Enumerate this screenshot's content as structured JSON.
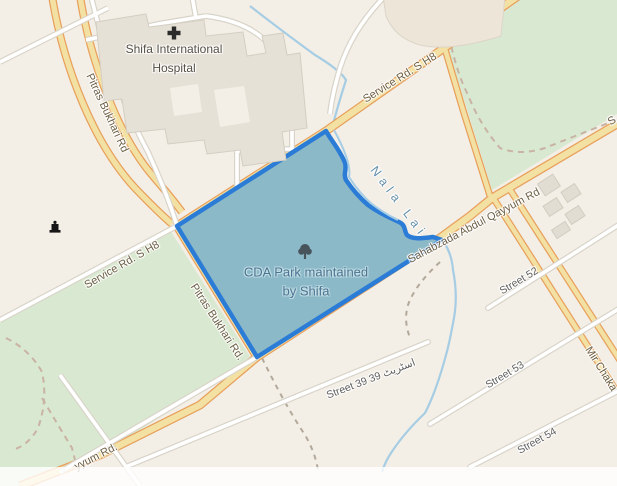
{
  "window": {
    "width": 617,
    "height": 486
  },
  "map": {
    "pois": {
      "hospital": {
        "name_line1": "Shifa International",
        "name_line2": "Hospital",
        "icon": "hospital-cross-icon"
      },
      "park": {
        "name_line1": "CDA Park maintained",
        "name_line2": "by Shifa",
        "icon": "park-tree-icon"
      },
      "monument": {
        "icon": "monument-icon"
      }
    },
    "water_labels": {
      "nala_lai": "Nala Lai"
    },
    "road_labels": {
      "pitras_top": "Pitras Bukhari Rd",
      "pitras_mid": "Pitras Bukhari Rd.",
      "service_left": "Service Rd. S H8",
      "service_top": "Service Rd. S H8",
      "sahabzada": "Sahabzada Abdul Qayyum Rd",
      "qayyum_partial": "yyum Rd.",
      "mir_partial": "Mir Chaka",
      "edge_partial": "S"
    },
    "street_labels": {
      "street_39": "Street 39 39 اسٹریٹ",
      "street_52": "Street 52",
      "street_53": "Street 53",
      "street_54": "Street 54"
    },
    "colors": {
      "background": "#f3efe7",
      "green_area": "#d9e8d0",
      "road_fill": "#f3e1a4",
      "road_casing": "#e8a05c",
      "minor_road": "#ffffff",
      "water": "#a6cde3",
      "park_fill": "#8cb9c7",
      "park_border": "#2b7cd6",
      "building": "#e6e1d7",
      "label_road": "#6d5f46",
      "label_street": "#5f5f5f",
      "label_water": "#6490ab",
      "label_park": "#4b7390",
      "label_poi": "#565046",
      "link": "#0078A8"
    }
  },
  "attribution": {
    "segments": [
      "Leaflet",
      " | Data by © ",
      "OpenStreetMap",
      ", under ",
      "ODbL.",
      ", © ",
      "Stadia Maps",
      " © ",
      "OpenMapTiles",
      " © ",
      "OpenStreetMap",
      " contributors"
    ]
  }
}
